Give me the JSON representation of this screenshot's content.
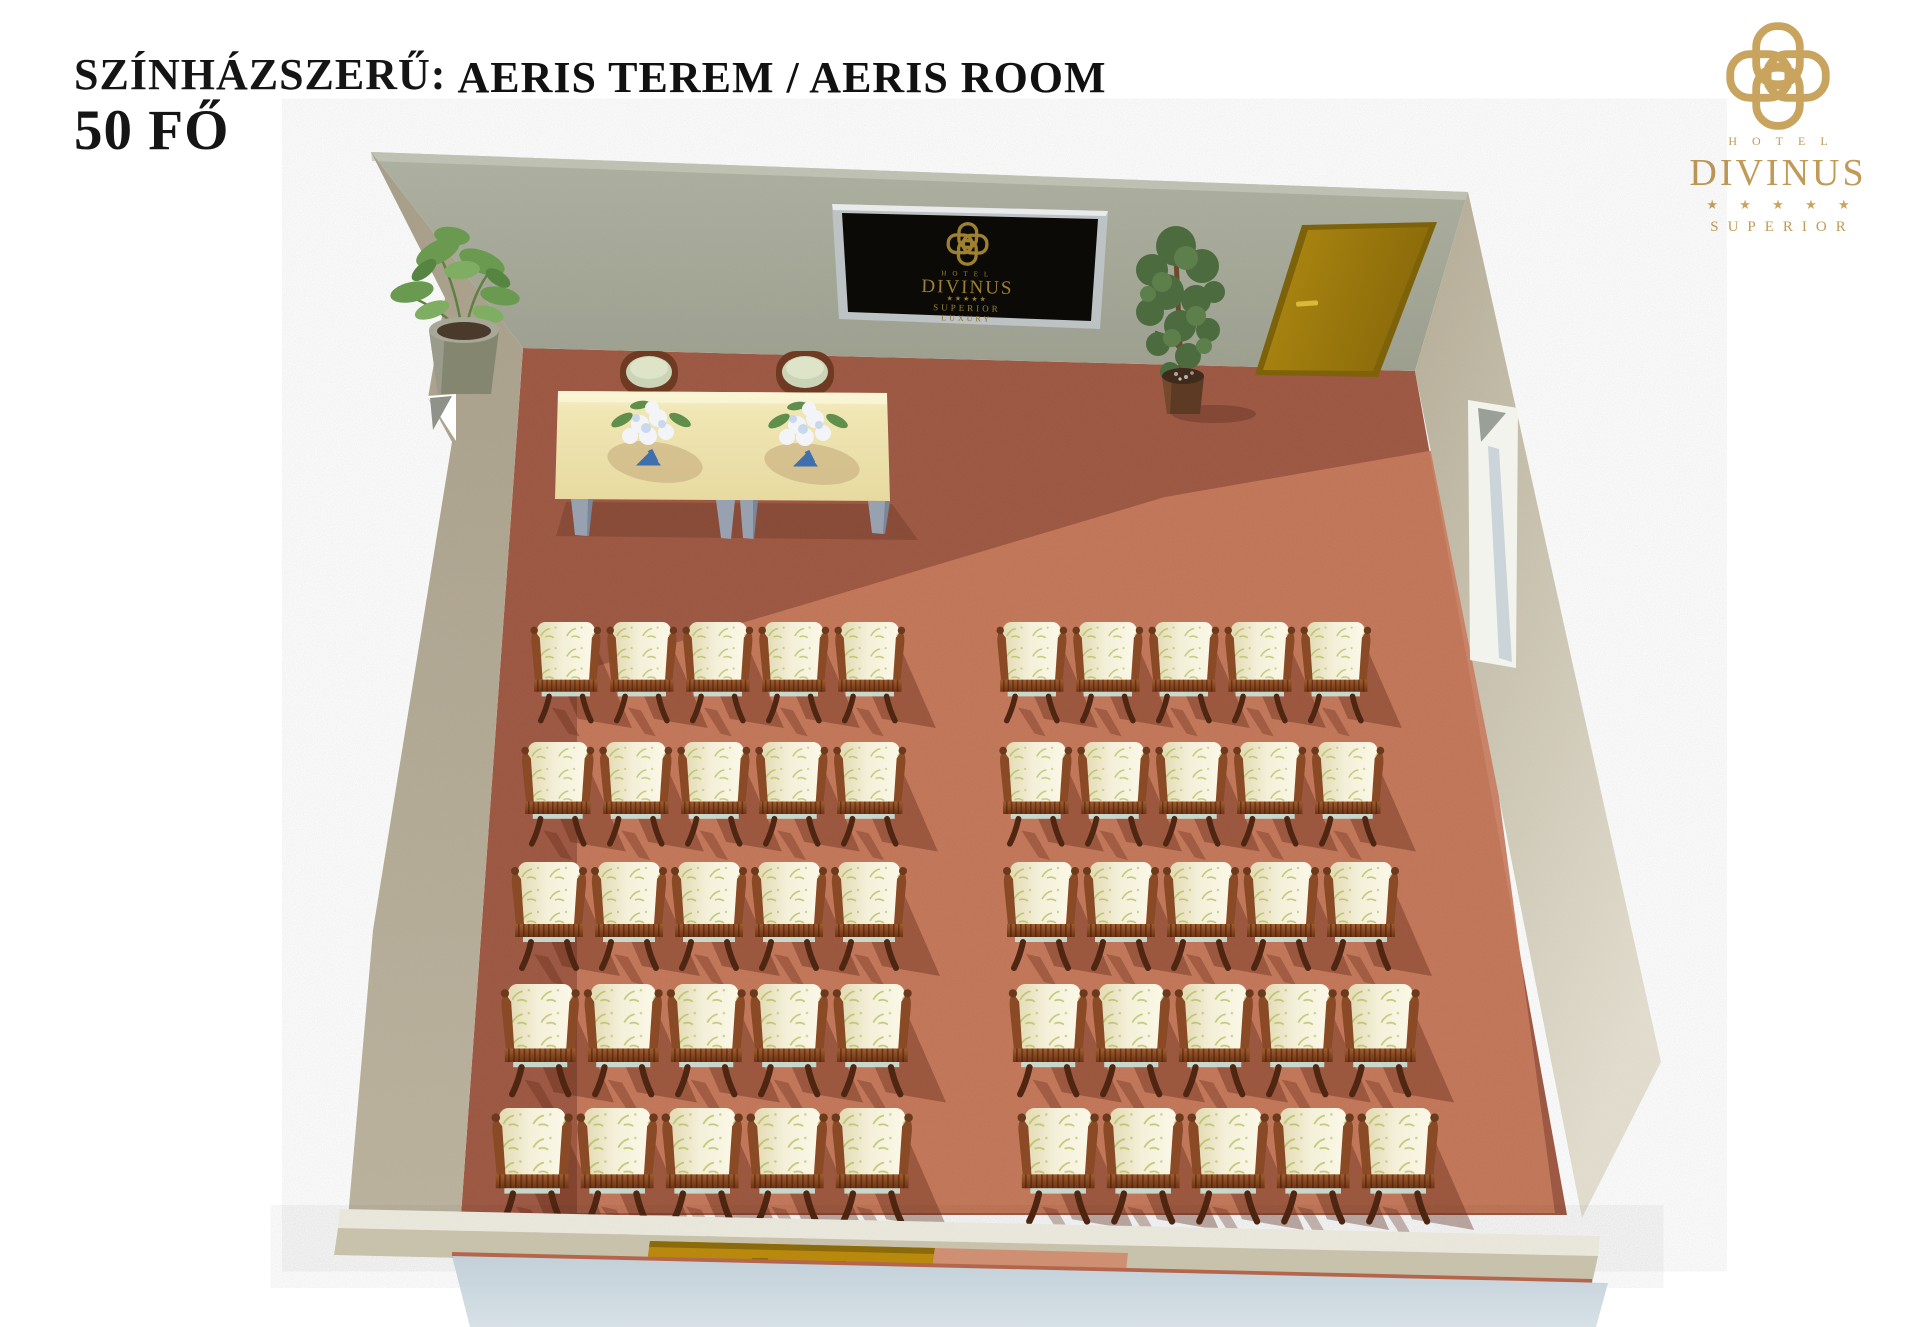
{
  "header": {
    "layout_label": "SZÍNHÁZSZERŰ:",
    "capacity": "50 FŐ",
    "title": "AERIS TEREM / AERIS ROOM"
  },
  "brand": {
    "hotel_word": "HOTEL",
    "name": "DIVINUS",
    "stars": "★ ★ ★ ★ ★",
    "tier": "SUPERIOR",
    "gold": "#c9a45e"
  },
  "tv_logo": {
    "hotel_word": "HOTEL",
    "name": "DIVINUS",
    "stars": "★★★★★",
    "tier": "SUPERIOR",
    "tier2": "LUXURY",
    "gold": "#9d8030"
  },
  "room": {
    "name": "AERIS",
    "seating": {
      "arrangement": "theater",
      "rows": 5,
      "columns_per_block": 5,
      "blocks": 2,
      "total_seats": 50
    },
    "colors": {
      "floor": "#a25c46",
      "floor_sunlit": "#cb7e60",
      "wall_back": "#a9ac9b",
      "wall_left": "#b3a995",
      "wall_right": "#c7c0ac",
      "wall_notch": "#f3f3ee",
      "door": "#a8830f",
      "door_frame": "#7e620a",
      "bottom_band_light": "#eceade",
      "bottom_band_beige": "#cbc5ae",
      "exterior_wall": "#ccd8e0",
      "table": "#efe5b0",
      "table_leg": "#97a1b0",
      "tv_frame": "#bdc2c5",
      "tv_screen": "#0b0a07",
      "chair_wood": "#8a4a26",
      "chair_wood_dark": "#4f2612",
      "chair_cushion": "#f3efd8",
      "chair_seat": "#c8ddd3",
      "sprig_green": "#a9b84b",
      "plant_green": "#6a9a50",
      "tree_green": "#4c6b3f",
      "pot_gray": "#9a9a8a",
      "pot_brown": "#5c3a24"
    }
  }
}
